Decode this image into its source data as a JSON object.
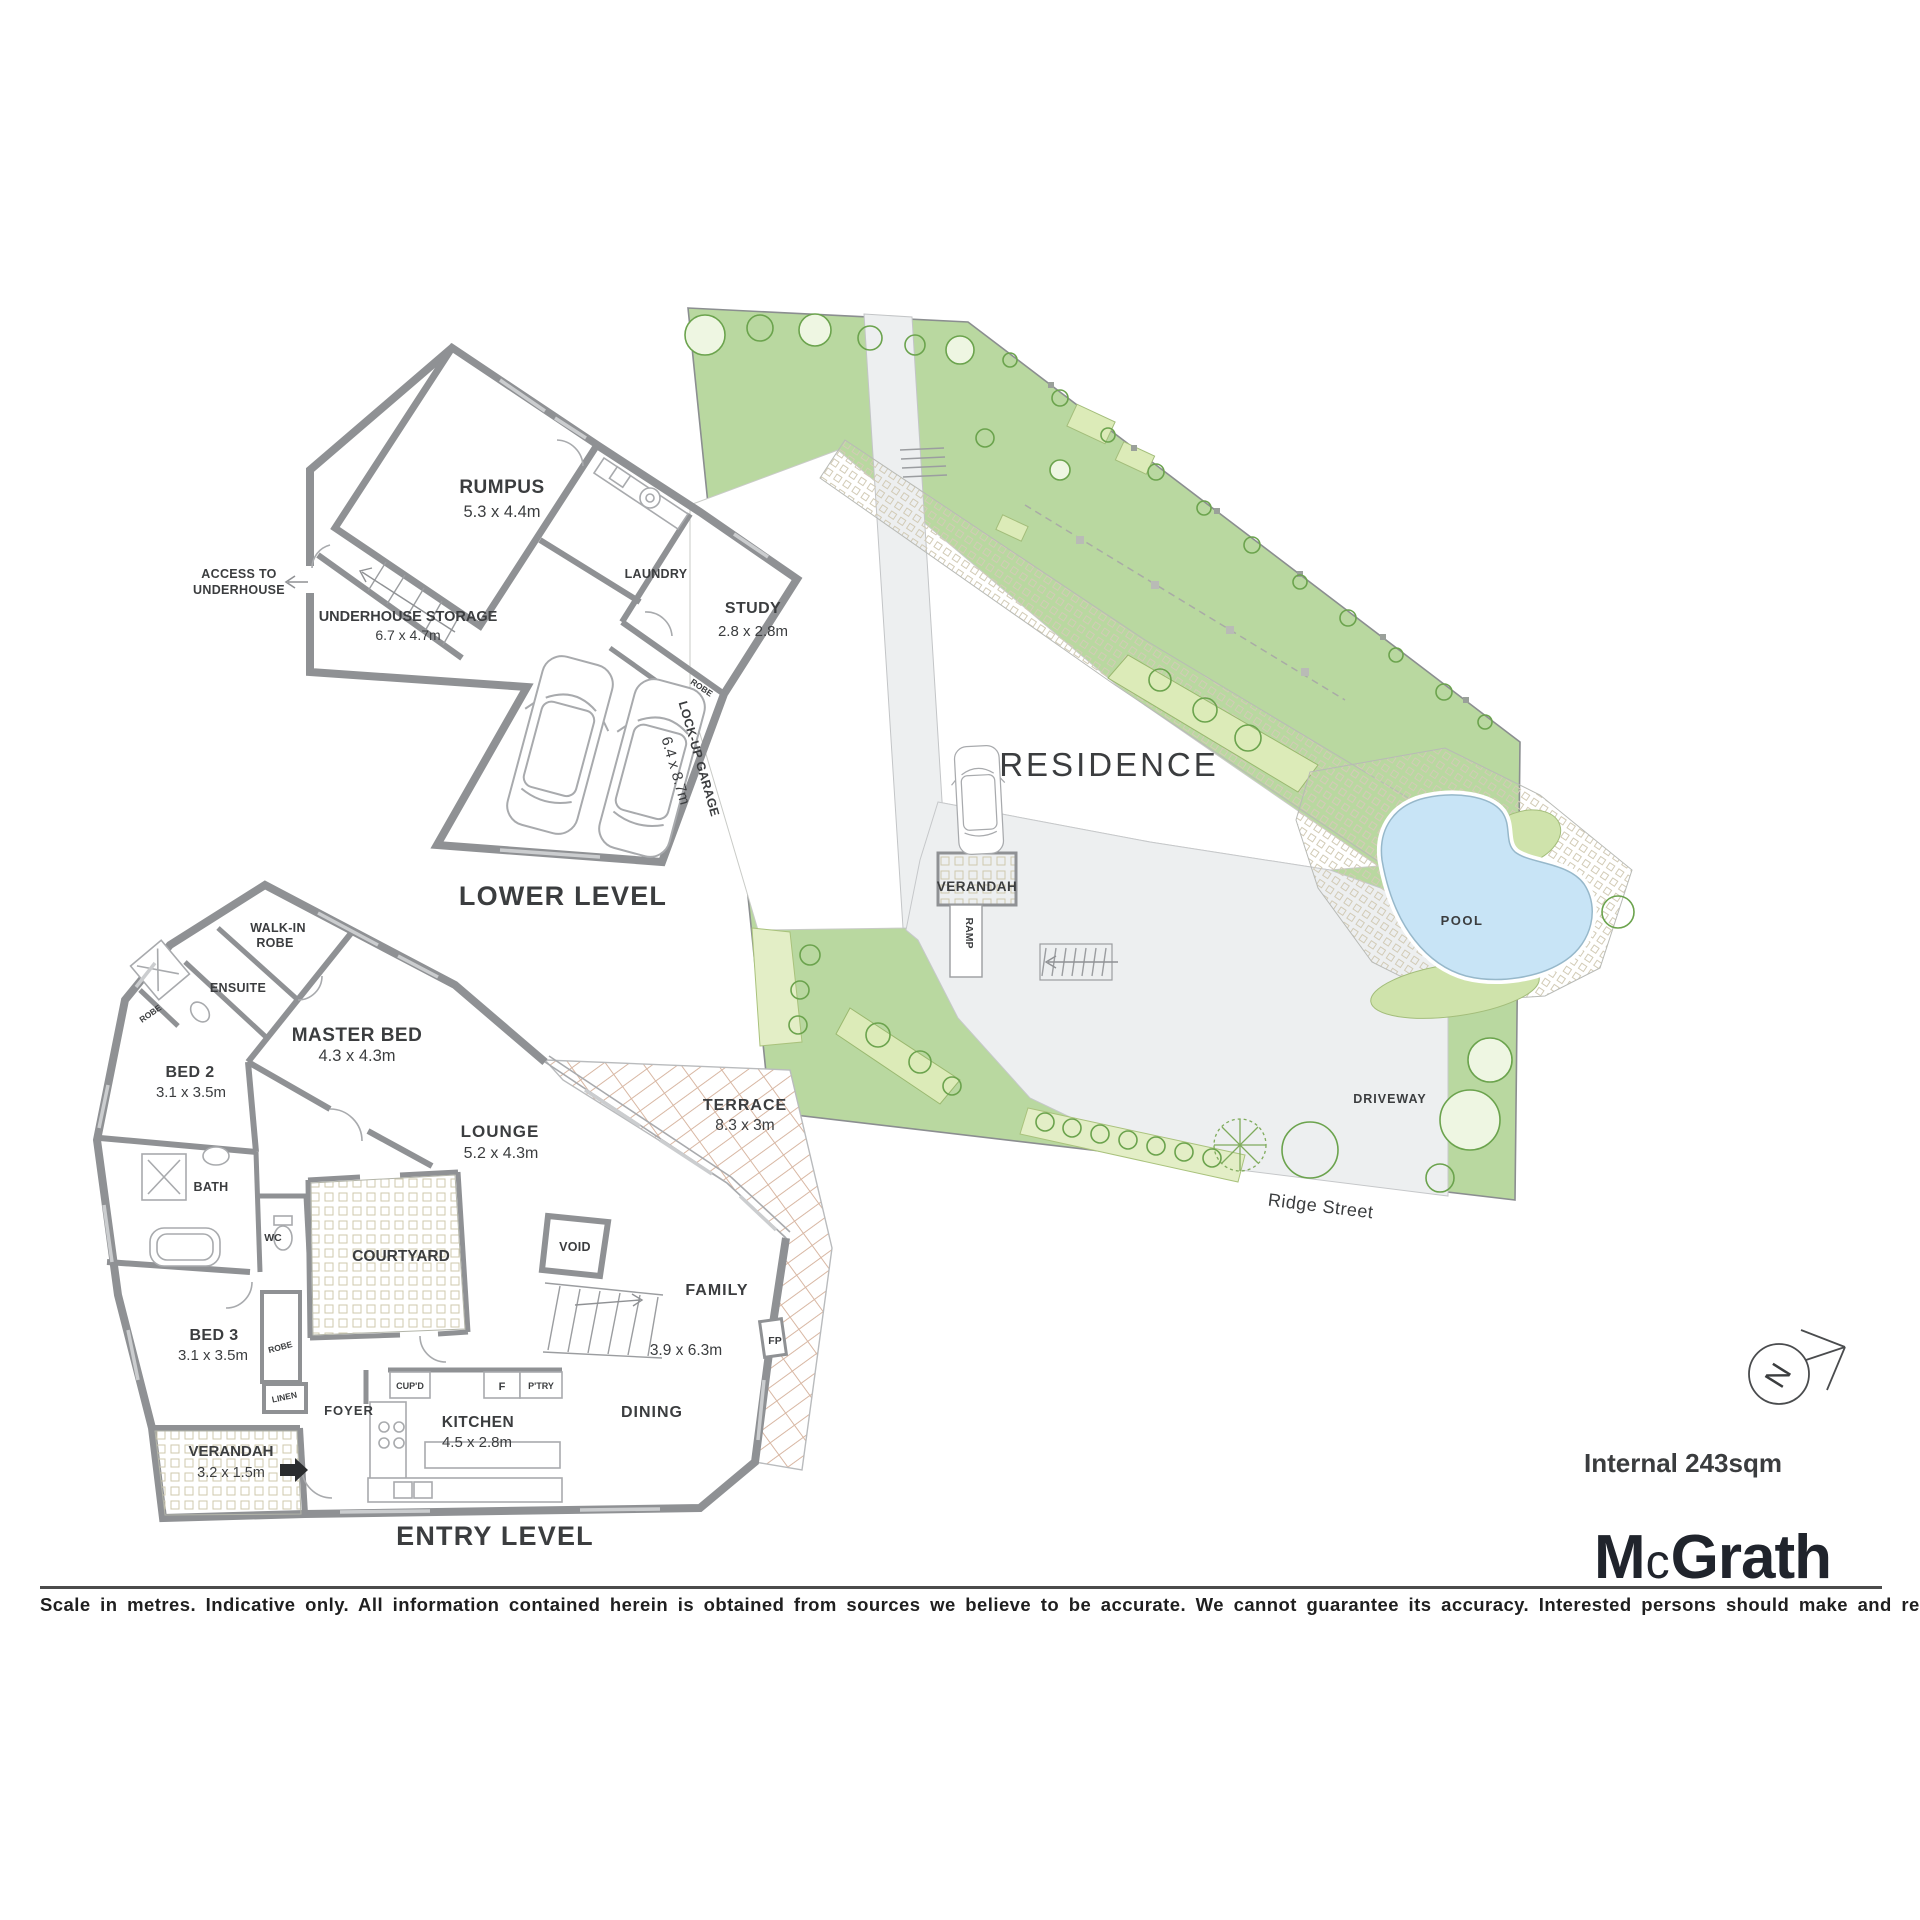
{
  "lower": {
    "caption": "LOWER LEVEL",
    "rumpus_name": "RUMPUS",
    "rumpus_dims": "5.3 x 4.4m",
    "laundry": "LAUNDRY",
    "study_name": "STUDY",
    "study_dims": "2.8 x 2.8m",
    "robe": "ROBE",
    "garage_name": "LOCK-UP GARAGE",
    "garage_dims": "6.4 x 8.7m",
    "storage_name": "UNDERHOUSE STORAGE",
    "storage_dims": "6.7 x 4.7m",
    "access_1": "ACCESS TO",
    "access_2": "UNDERHOUSE"
  },
  "entry": {
    "caption": "ENTRY LEVEL",
    "wir_1": "WALK-IN",
    "wir_2": "ROBE",
    "ensuite": "ENSUITE",
    "robe_left": "ROBE",
    "bed2_name": "BED 2",
    "bed2_dims": "3.1 x 3.5m",
    "master_name": "MASTER BED",
    "master_dims": "4.3 x 4.3m",
    "bath": "BATH",
    "wc": "WC",
    "bed3_name": "BED 3",
    "bed3_dims": "3.1 x 3.5m",
    "robe_bed3": "ROBE",
    "linen": "LINEN",
    "foyer": "FOYER",
    "verandah_name": "VERANDAH",
    "verandah_dims": "3.2 x 1.5m",
    "courtyard": "COURTYARD",
    "lounge_name": "LOUNGE",
    "lounge_dims": "5.2 x 4.3m",
    "void": "VOID",
    "terrace_name": "TERRACE",
    "terrace_dims": "8.3 x 3m",
    "family_name": "FAMILY",
    "family_dims": "3.9 x 6.3m",
    "dining": "DINING",
    "kitchen_name": "KITCHEN",
    "kitchen_dims": "4.5 x 2.8m",
    "cupd": "CUP'D",
    "fridge": "F",
    "pantry": "P'TRY",
    "fp": "FP"
  },
  "site": {
    "residence": "RESIDENCE",
    "verandah": "VERANDAH",
    "ramp": "RAMP",
    "pool": "POOL",
    "driveway": "DRIVEWAY",
    "street": "Ridge Street"
  },
  "compass": {
    "north": "N"
  },
  "meta": {
    "internal_area": "Internal 243sqm",
    "logo_m": "M",
    "logo_c": "c",
    "logo_rest": "Grath",
    "disclaimer": "Scale in metres. Indicative only. All information contained herein is obtained from sources we believe to be accurate. We cannot guarantee its accuracy. Interested persons should make and rely on their own enquiries."
  },
  "colors": {
    "wall": "#8f9194",
    "lawn": "#b9d8a0",
    "garden_bed": "#dcebb8",
    "pool": "#c8e4f6",
    "path": "#edeff0",
    "terrace_hatch": "#d8b7a3",
    "text": "#3b3d3f"
  }
}
